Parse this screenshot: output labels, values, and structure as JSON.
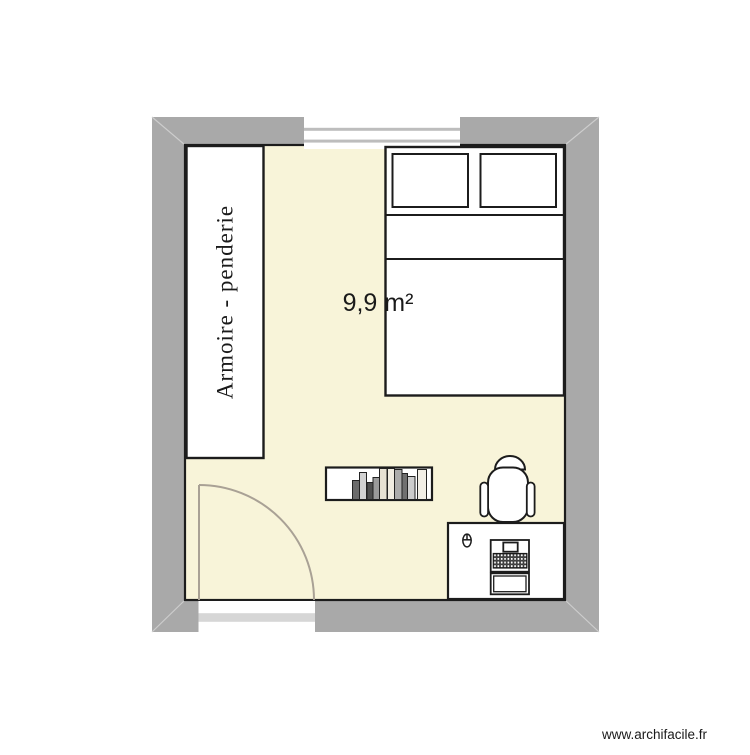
{
  "watermark": {
    "text": "www.archifacile.fr",
    "color": "#1a1a1a"
  },
  "plan": {
    "room": {
      "area_label": "9,9 m²"
    },
    "colors": {
      "wall": "#a9a9a9",
      "miter_line": "#cdcdcd",
      "floor": "#f8f4d9",
      "outline": "#1c1c1c",
      "furniture_fill": "#ffffff",
      "door_swing": "#a9a195",
      "window_divider": "#bdbdbd",
      "door_gap": "#d6d6d6",
      "label_text": "#1a1a1a"
    },
    "openings": {
      "window": {
        "wall": "top"
      },
      "door": {
        "wall": "bottom",
        "swing": "quarter-circle"
      }
    },
    "furniture": {
      "wardrobe": {
        "label": "Armoire - penderie"
      },
      "bed": {
        "type": "double-bed",
        "pillow_count": 2
      },
      "bookshelf": {
        "book_count": 10,
        "books": [
          {
            "x": 352.5,
            "w": 7,
            "h": 19,
            "shade": "#6b6b6b"
          },
          {
            "x": 359.5,
            "w": 7,
            "h": 27,
            "shade": "#d2d2d2"
          },
          {
            "x": 367,
            "w": 6,
            "h": 17,
            "shade": "#4f4f4f"
          },
          {
            "x": 373,
            "w": 6.5,
            "h": 22,
            "shade": "#9a9a9a"
          },
          {
            "x": 379.5,
            "w": 7.5,
            "h": 31,
            "shade": "#e6e1d3"
          },
          {
            "x": 387.5,
            "w": 7,
            "h": 31,
            "shade": "#f0ece1"
          },
          {
            "x": 394.5,
            "w": 7.5,
            "h": 30,
            "shade": "#ababab"
          },
          {
            "x": 402,
            "w": 5.5,
            "h": 26,
            "shade": "#707070"
          },
          {
            "x": 407.5,
            "w": 7.5,
            "h": 23,
            "shade": "#cdcdcd"
          },
          {
            "x": 417.5,
            "w": 9,
            "h": 30,
            "shade": "#f2efe6"
          }
        ]
      },
      "desk": {
        "items": [
          "mouse",
          "monitor",
          "keyboard",
          "laptop"
        ]
      },
      "chair": {
        "type": "desk-chair"
      }
    }
  }
}
